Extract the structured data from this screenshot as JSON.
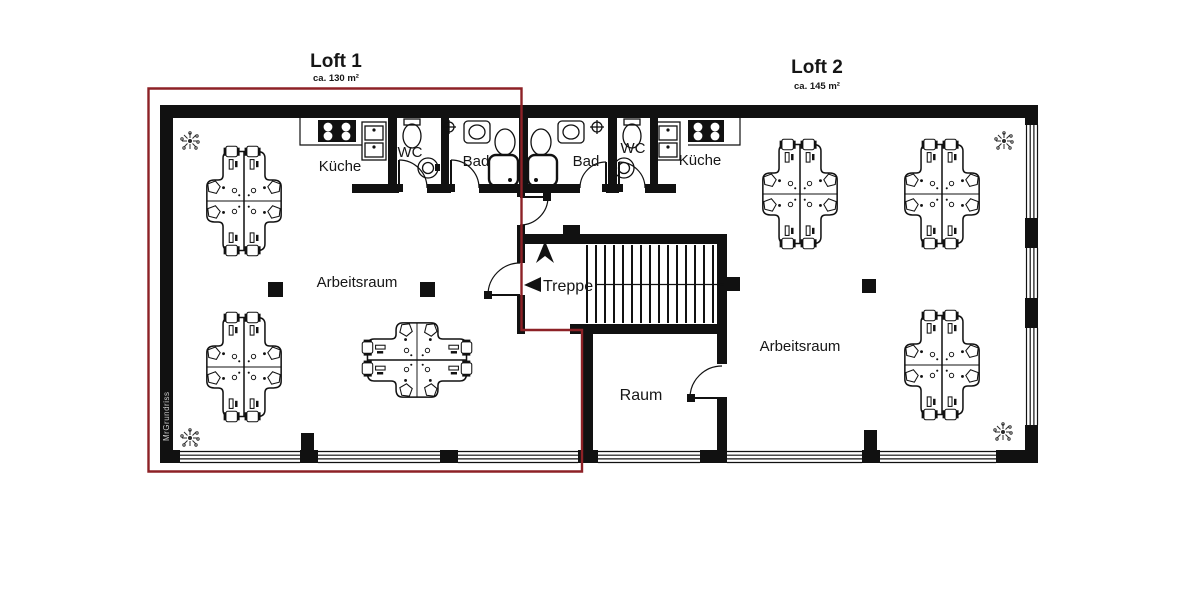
{
  "lofts": {
    "loft1": {
      "name": "Loft 1",
      "area": "ca. 130 m²",
      "label_color": "#b23b43",
      "outline_color": "#8d2126"
    },
    "loft2": {
      "name": "Loft 2",
      "area": "ca. 145 m²",
      "label_color": "#b9d444"
    }
  },
  "rooms": {
    "kueche_left": "Küche",
    "wc_left": "WC",
    "bad_left": "Bad",
    "bad_right": "Bad",
    "wc_right": "WC",
    "kueche_right": "Küche",
    "arbeitsraum_left": "Arbeitsraum",
    "treppe": "Treppe",
    "raum": "Raum",
    "arbeitsraum_right": "Arbeitsraum"
  },
  "watermark": "MrGrundriss",
  "colors": {
    "wall": "#111111",
    "background": "#ffffff"
  }
}
